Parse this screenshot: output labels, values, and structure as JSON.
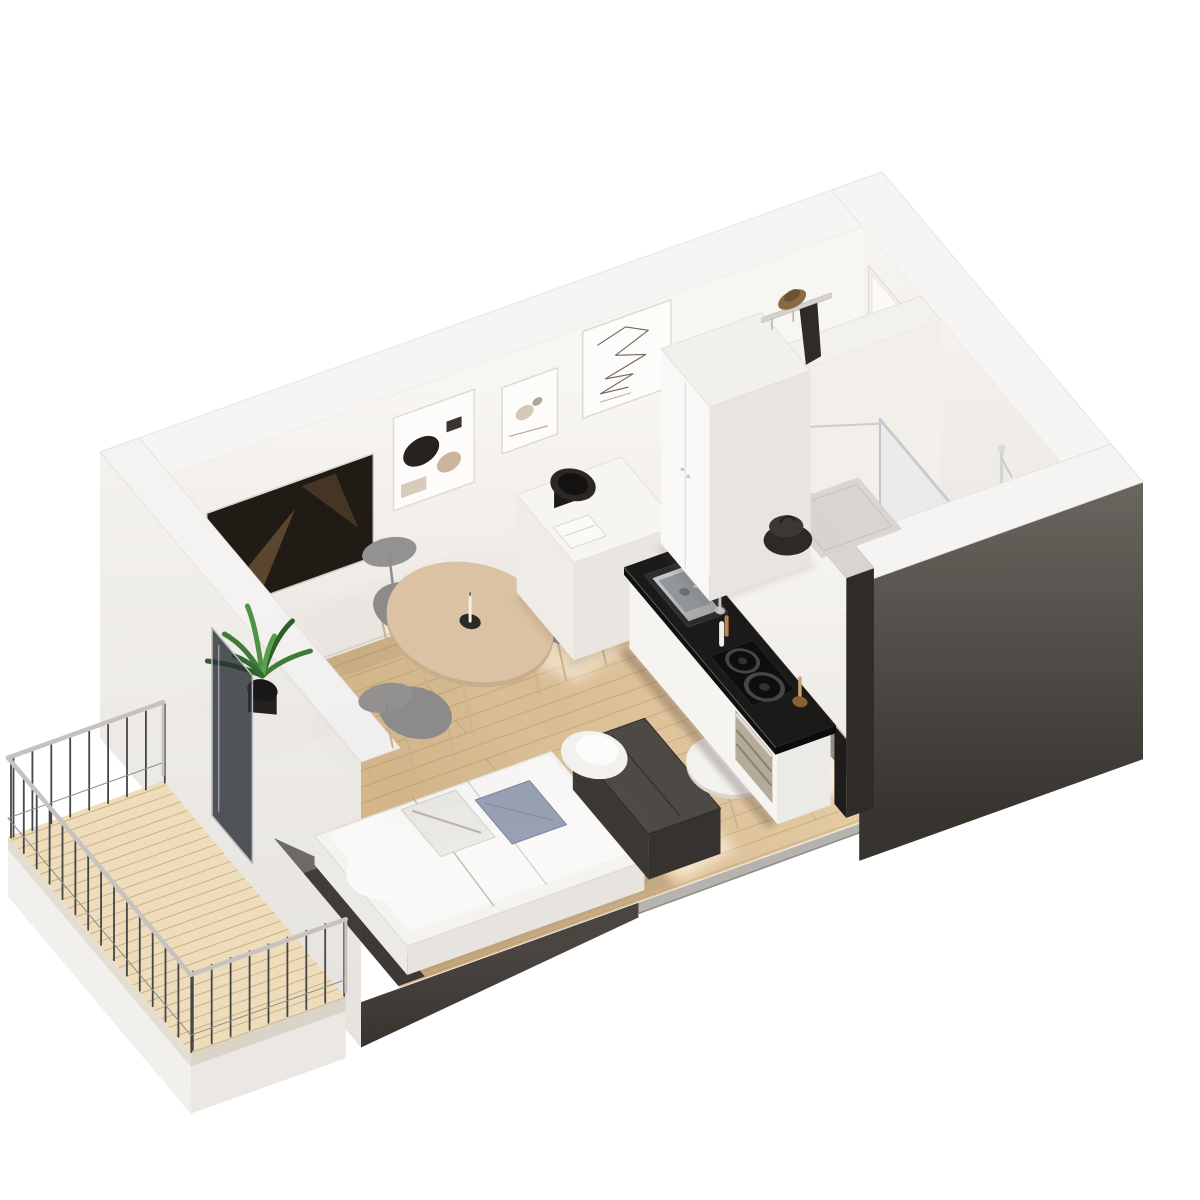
{
  "image": {
    "type": "3d-floorplan-render",
    "style": "isometric cutaway",
    "title": "Studio apartment 3D floor plan",
    "background": "#ffffff"
  },
  "rooms": [
    {
      "name": "living-sleeping-area",
      "floor": "light-oak-planks"
    },
    {
      "name": "kitchenette",
      "floor": "light-oak-planks"
    },
    {
      "name": "bathroom",
      "floor": "gray-tile"
    },
    {
      "name": "entry-hall",
      "floor": "light-oak-planks"
    },
    {
      "name": "balcony",
      "floor": "wood-decking"
    }
  ],
  "furniture": [
    {
      "name": "bed",
      "desc": "double bed with white duvet and pillows"
    },
    {
      "name": "bed-foot-bench",
      "desc": "dark upholstered bench at bed foot"
    },
    {
      "name": "blue-cushion",
      "desc": "blue-gray cushion on bed"
    },
    {
      "name": "side-table",
      "desc": "small round white table with dried flowers"
    },
    {
      "name": "dining-table",
      "desc": "round light-wood dining table with candle"
    },
    {
      "name": "dining-chair",
      "desc": "three gray chairs with wood legs"
    },
    {
      "name": "media-sideboard",
      "desc": "white sideboard with speaker and book"
    },
    {
      "name": "wall-tv",
      "desc": "flat TV on wall"
    },
    {
      "name": "art-frame-abstract",
      "desc": "framed abstract shapes print"
    },
    {
      "name": "art-frame-sketch",
      "desc": "framed small sketch"
    },
    {
      "name": "art-frame-line-art",
      "desc": "framed one-line drawing"
    },
    {
      "name": "potted-plant",
      "desc": "green plant in dark pot"
    },
    {
      "name": "kitchen-unit",
      "desc": "white cabinets, black counter, sink, faucet, hob, oven, bottles"
    },
    {
      "name": "wardrobe",
      "desc": "tall white wardrobe at entry"
    },
    {
      "name": "coat-shelf",
      "desc": "wall shelf with hat and dark coat"
    },
    {
      "name": "bag",
      "desc": "dark bag on entry floor"
    },
    {
      "name": "entry-door",
      "desc": "white entry door in wall"
    },
    {
      "name": "doormat",
      "desc": "gray doormat"
    },
    {
      "name": "toilet",
      "desc": "white toilet"
    },
    {
      "name": "shower",
      "desc": "walk-in shower with glass panel and chrome column"
    },
    {
      "name": "storage-cube",
      "desc": "white cube at bathroom doorway"
    },
    {
      "name": "balcony-railing",
      "desc": "metal railing with light top rail"
    },
    {
      "name": "balcony-door",
      "desc": "open dark glass balcony door"
    }
  ],
  "colors": {
    "background": "#ffffff",
    "wall_top": "#f7f5f3",
    "wall_face_light": "#f6f4f1",
    "wall_face_shade": "#ebe7e1",
    "wall_dark": "#37332e",
    "wall_dark_light": "#6e6a64",
    "floor_wood": "#e2c89f",
    "floor_wood_deep": "#d0b083",
    "plank_line": "rgba(150,108,62,0.28)",
    "tile": "#8f8c88",
    "tile_dark": "#73706c",
    "grout": "rgba(255,255,255,0.16)",
    "counter": "#1b1a19",
    "cabinet": "#f6f4f1",
    "steel": "#c6c9cb",
    "table_wood": "#dcc2a4",
    "chair_seat": "#8e8b8b",
    "leg_wood": "#cbb292",
    "bed_white": "#f5f3f0",
    "bed_shade": "#e7e3de",
    "pillow_blue": "#98a0b4",
    "bench": "#4e4a46",
    "bench_dark": "#363230",
    "plant_green": "#3e7c38",
    "plant_green_dark": "#2f6029",
    "pot": "#24211e",
    "deck_wood": "#eedcba",
    "deck_line": "rgba(166,135,88,0.5)",
    "rail_light": "#c6c3bf",
    "rail_dark": "#45464a",
    "sunlight": "#fff4e2",
    "glass": "rgba(213,228,234,0.30)",
    "shadow": "rgba(80,62,45,0.18)"
  }
}
